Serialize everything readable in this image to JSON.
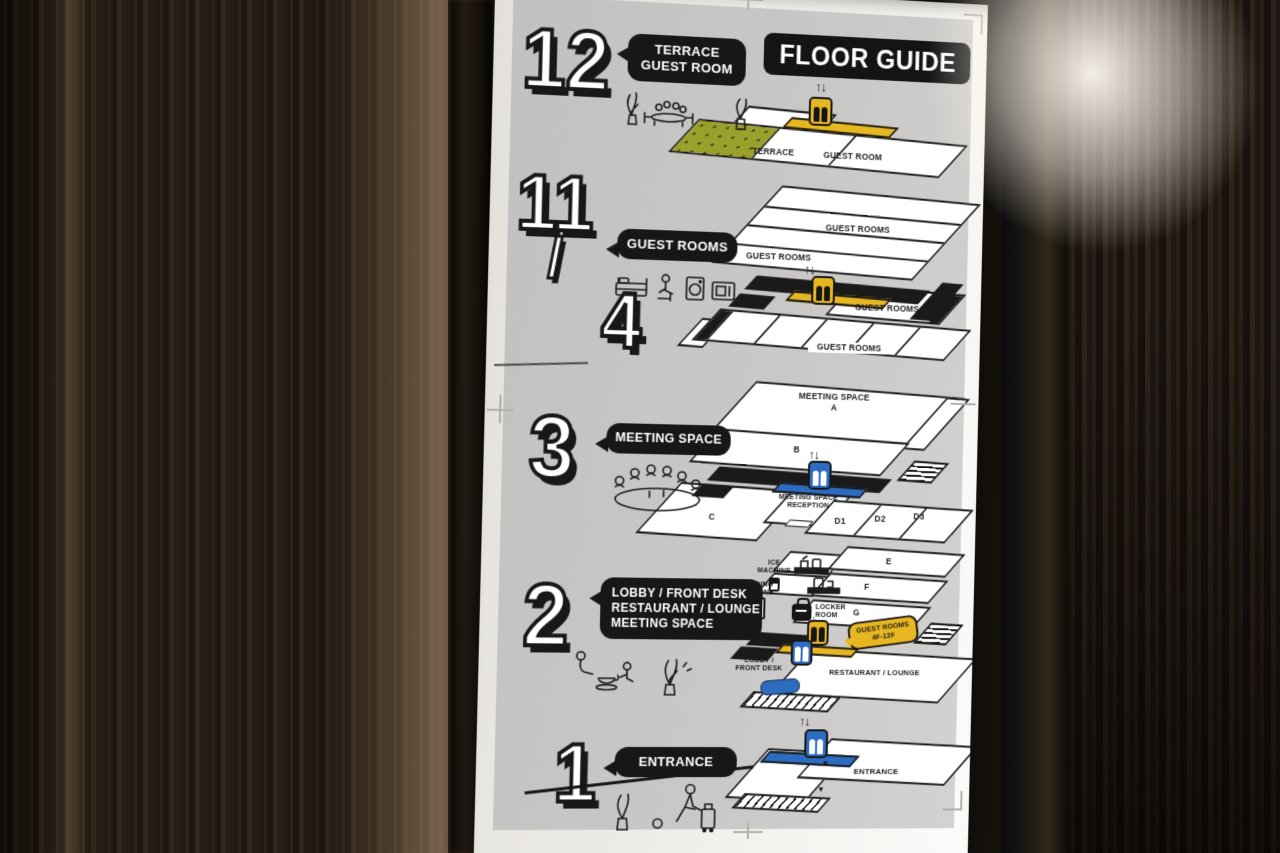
{
  "sign": {
    "title": "FLOOR GUIDE",
    "icons": {
      "elevator_arrows": "↑↓",
      "entry_arrow": "▼"
    },
    "floors": [
      {
        "id": "12",
        "number": "12",
        "bubble_lines": [
          "TERRACE",
          "GUEST ROOM"
        ],
        "plan": {
          "terrace": "TERRACE",
          "guest_room": "GUEST ROOM"
        }
      },
      {
        "id": "11-4",
        "number_top": "11",
        "number_slash": "/",
        "number_bottom": "4",
        "bubble_lines": [
          "GUEST ROOMS"
        ],
        "plan": {
          "label_1": "GUEST ROOMS",
          "label_2": "GUEST ROOMS",
          "label_3": "GUEST ROOMS",
          "label_4": "GUEST ROOMS"
        }
      },
      {
        "id": "3",
        "number": "3",
        "bubble_lines": [
          "MEETING SPACE"
        ],
        "plan": {
          "meeting_space_line1": "MEETING SPACE",
          "meeting_space_line2": "A",
          "room_b": "B",
          "room_c": "C",
          "reception_line1": "MEETING SPACE",
          "reception_line2": "RECEPTION",
          "room_d1": "D1",
          "room_d2": "D2",
          "room_d3": "D3"
        }
      },
      {
        "id": "2",
        "number": "2",
        "bubble_lines": [
          "LOBBY / FRONT DESK",
          "RESTAURANT / LOUNGE",
          "MEETING SPACE"
        ],
        "plan": {
          "ice_line1": "ICE",
          "ice_line2": "MACHINE",
          "vending_line1": "VENDING",
          "vending_line2": "MACHINE",
          "locker_line1": "LOCKER",
          "locker_line2": "ROOM",
          "tag_line1": "GUEST ROOMS",
          "tag_line2": "4F-12F",
          "room_e": "E",
          "room_f": "F",
          "room_g": "G",
          "lobby_line1": "LOBBY /",
          "lobby_line2": "FRONT DESK",
          "restaurant": "RESTAURANT / LOUNGE"
        }
      },
      {
        "id": "1",
        "number": "1",
        "bubble_lines": [
          "ENTRANCE"
        ],
        "plan": {
          "entrance": "ENTRANCE"
        }
      }
    ],
    "colors": {
      "ink": "#1a1a1a",
      "paper": "#f2f0ec",
      "panel": "#c8c7c5",
      "yellow": "#e7b722",
      "olive": "#9aa02c",
      "blue": "#2e6cc0"
    }
  }
}
